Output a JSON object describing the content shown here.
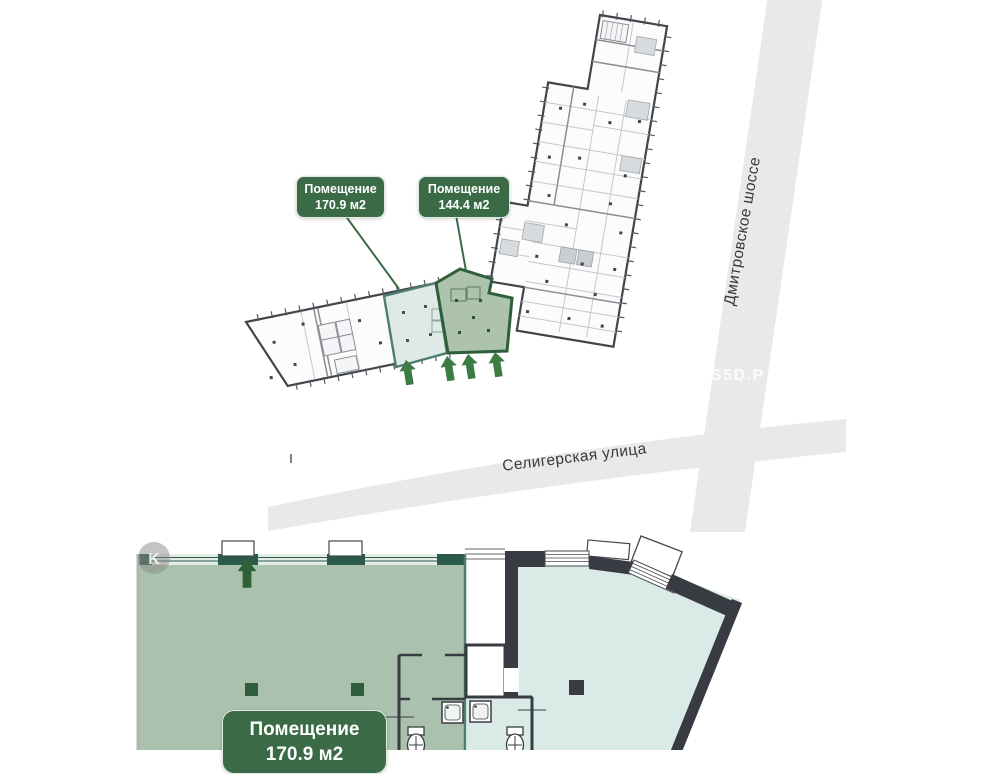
{
  "map": {
    "premises_labels": [
      {
        "title": "Помещение",
        "area": "170.9 м2"
      },
      {
        "title": "Помещение",
        "area": "144.4 м2"
      }
    ],
    "streets": [
      {
        "name": "Дмитровское шоссе"
      },
      {
        "name": "Селигерская улица"
      }
    ],
    "watermark": "S5D.Р"
  },
  "plan": {
    "corner_badge": "K",
    "label": {
      "title": "Помещение",
      "area": "170.9 м2"
    }
  },
  "colors": {
    "label_green": "#3A6B46",
    "premises_170_fill": "#DFEAE6",
    "premises_170_stroke": "#4D7E72",
    "premises_144_fill": "#ADC3AE",
    "premises_144_stroke": "#2E5F3A",
    "arrow_green": "#3E7C46",
    "road_gray": "#E9E9EA",
    "wall_dark": "#383C42",
    "room_170_fill": "#A9C1AD",
    "room_170_wall": "#2B5A49",
    "room_144_fill": "#DAEBE7"
  }
}
